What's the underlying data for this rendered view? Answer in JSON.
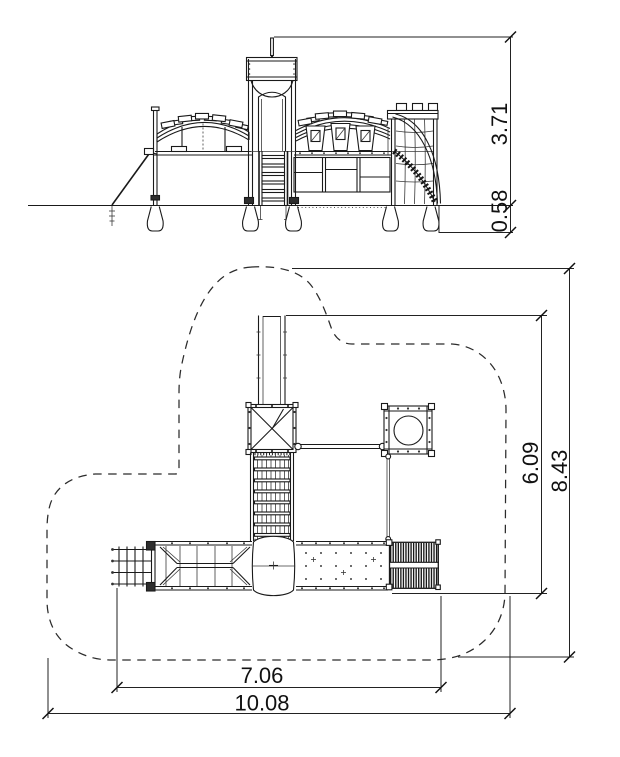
{
  "sheet": {
    "background": "#ffffff",
    "line_color": "#1a1a1a",
    "content": "playground equipment technical drawing, side elevation above, top plan below"
  },
  "elevation_view": {
    "label": "side-elevation",
    "dimensions": {
      "overall_height_m": "3.71",
      "foundation_depth_m": "0.58"
    }
  },
  "plan_view": {
    "label": "top-plan",
    "dimensions": {
      "equipment_depth_m": "6.09",
      "safety_zone_depth_m": "8.43",
      "equipment_width_m": "7.06",
      "safety_zone_width_m": "10.08"
    }
  }
}
